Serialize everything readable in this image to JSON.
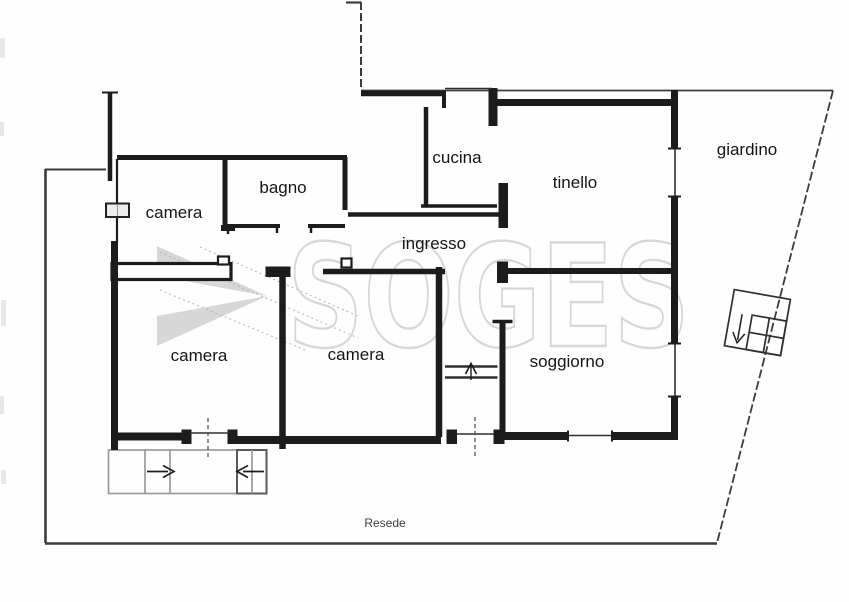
{
  "plan": {
    "labels": {
      "camera_top": "camera",
      "bagno": "bagno",
      "cucina": "cucina",
      "tinello": "tinello",
      "giardino": "giardino",
      "ingresso": "ingresso",
      "camera_left": "camera",
      "camera_mid": "camera",
      "soggiorno": "soggiorno",
      "resede": "Resede"
    },
    "watermark": {
      "text": "SOGES",
      "logo": "soges-ribbon-triangle",
      "stroke_color": "#d7d7d7",
      "logo_color": "#c6c6c6"
    },
    "symbols": {
      "entry_stair_arrow_right": "→",
      "entry_stair_arrow_left": "←",
      "interior_step_arrow_up": "↑",
      "garden_stair_arrow_down": "↓"
    },
    "colors": {
      "wall": "#1c1c1c",
      "boundary": "#3c3c3c",
      "stairs": "#9a9a9a",
      "background": "#fefefe",
      "label_text": "#161616"
    }
  }
}
